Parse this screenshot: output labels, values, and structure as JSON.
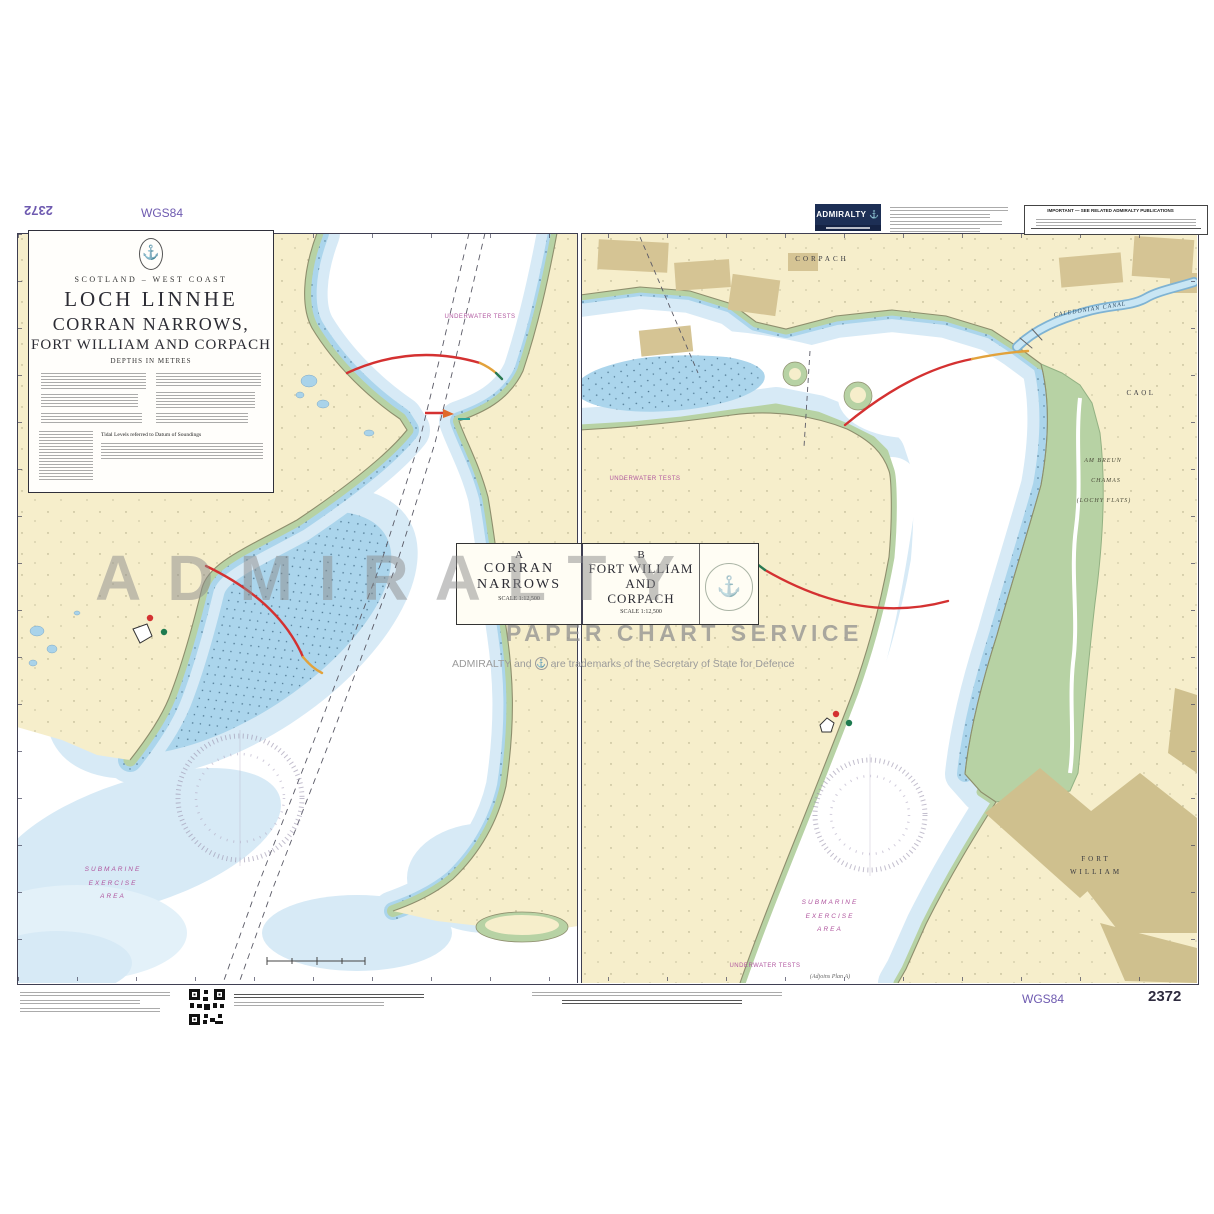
{
  "chart": {
    "number": "2372",
    "datum": "WGS84"
  },
  "logo": {
    "brand": "ADMIRALTY",
    "anchor_icon": "⚓"
  },
  "notice": {
    "title": "IMPORTANT — SEE RELATED ADMIRALTY PUBLICATIONS"
  },
  "title_block": {
    "anchor_icon": "⚓",
    "region": "SCOTLAND – WEST COAST",
    "title1": "LOCH LINNHE",
    "title2": "CORRAN NARROWS,",
    "title3": "FORT WILLIAM AND CORPACH",
    "depths": "DEPTHS IN METRES",
    "tidal_caption": "Tidal Levels referred to Datum of Soundings"
  },
  "panel_titles": {
    "a": {
      "letter": "A",
      "line1": "CORRAN",
      "line2": "NARROWS",
      "scale": "SCALE 1:12,500"
    },
    "b": {
      "letter": "B",
      "line1": "FORT WILLIAM",
      "line2": "AND",
      "line3": "CORPACH",
      "scale": "SCALE 1:12,500"
    },
    "anchor_icon": "⚓"
  },
  "watermark": {
    "brand": "ADMIRALTY",
    "service": "PAPER CHART SERVICE",
    "tm_prefix": "ADMIRALTY and",
    "tm_icon": "⚓",
    "tm_suffix": "are trademarks of the Secretary of State for Defence"
  },
  "map_a": {
    "underwater_tests": "UNDERWATER TESTS",
    "submarine1": "SUBMARINE",
    "submarine2": "EXERCISE",
    "submarine3": "AREA"
  },
  "map_b": {
    "corpach": "CORPACH",
    "canal": "CALEDONIAN CANAL",
    "caol": "CAOL",
    "flats1": "AM BREUN",
    "flats2": "CHAMAS",
    "flats3": "(LOCHY FLATS)",
    "fort1": "FORT",
    "fort2": "WILLIAM",
    "submarine1": "SUBMARINE",
    "submarine2": "EXERCISE",
    "submarine3": "AREA",
    "underwater_tests1": "UNDERWATER TESTS",
    "underwater_tests2": "UNDERWATER TESTS",
    "adjoins": "(Adjoins Plan A)"
  },
  "colors": {
    "land": "#f6eecb",
    "builtup": "#d5c494",
    "intertidal_green": "#b7d2a4",
    "shallow_light": "#d7eaf6",
    "shallow_mid": "#abd5ec",
    "deep": "#ffffff",
    "magenta": "#b0569f",
    "datum_purple": "#6e5ab0",
    "logo_navy": "#1d2f55",
    "light_red": "#d43131",
    "light_yellow": "#e2a23b",
    "light_green": "#2a7a52"
  }
}
